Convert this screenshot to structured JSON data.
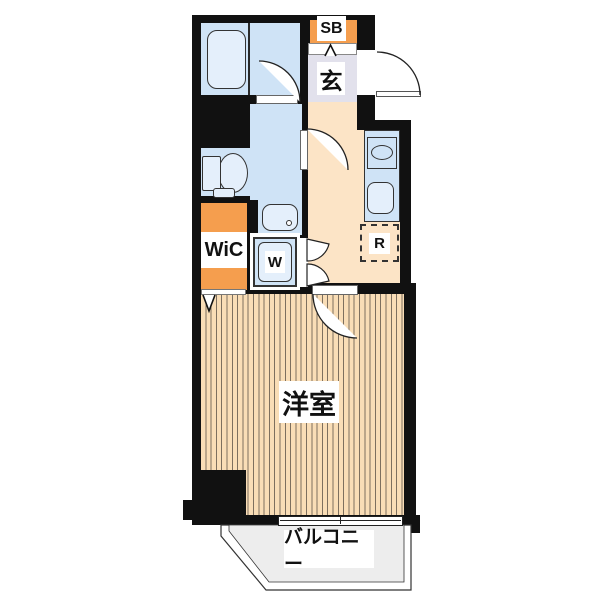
{
  "plan": {
    "title": "apartment-floor-plan",
    "labels": {
      "shoe_box": "SB",
      "entrance": "玄",
      "walk_in_closet": "WiC",
      "washer": "W",
      "refrigerator": "R",
      "western_room": "洋室",
      "balcony": "バルコニー"
    },
    "colors": {
      "wall": "#111111",
      "wet_area_floor": "#cfe3f6",
      "fixture_fill": "#e4effb",
      "accent_orange": "#f59e4e",
      "entrance_floor": "#e2e1ec",
      "kitchen_floor": "#fce4c6",
      "room_floor": "#f9ddb6",
      "room_floor_stripe": "#7d6f5e",
      "balcony_floor": "#ededed"
    }
  }
}
